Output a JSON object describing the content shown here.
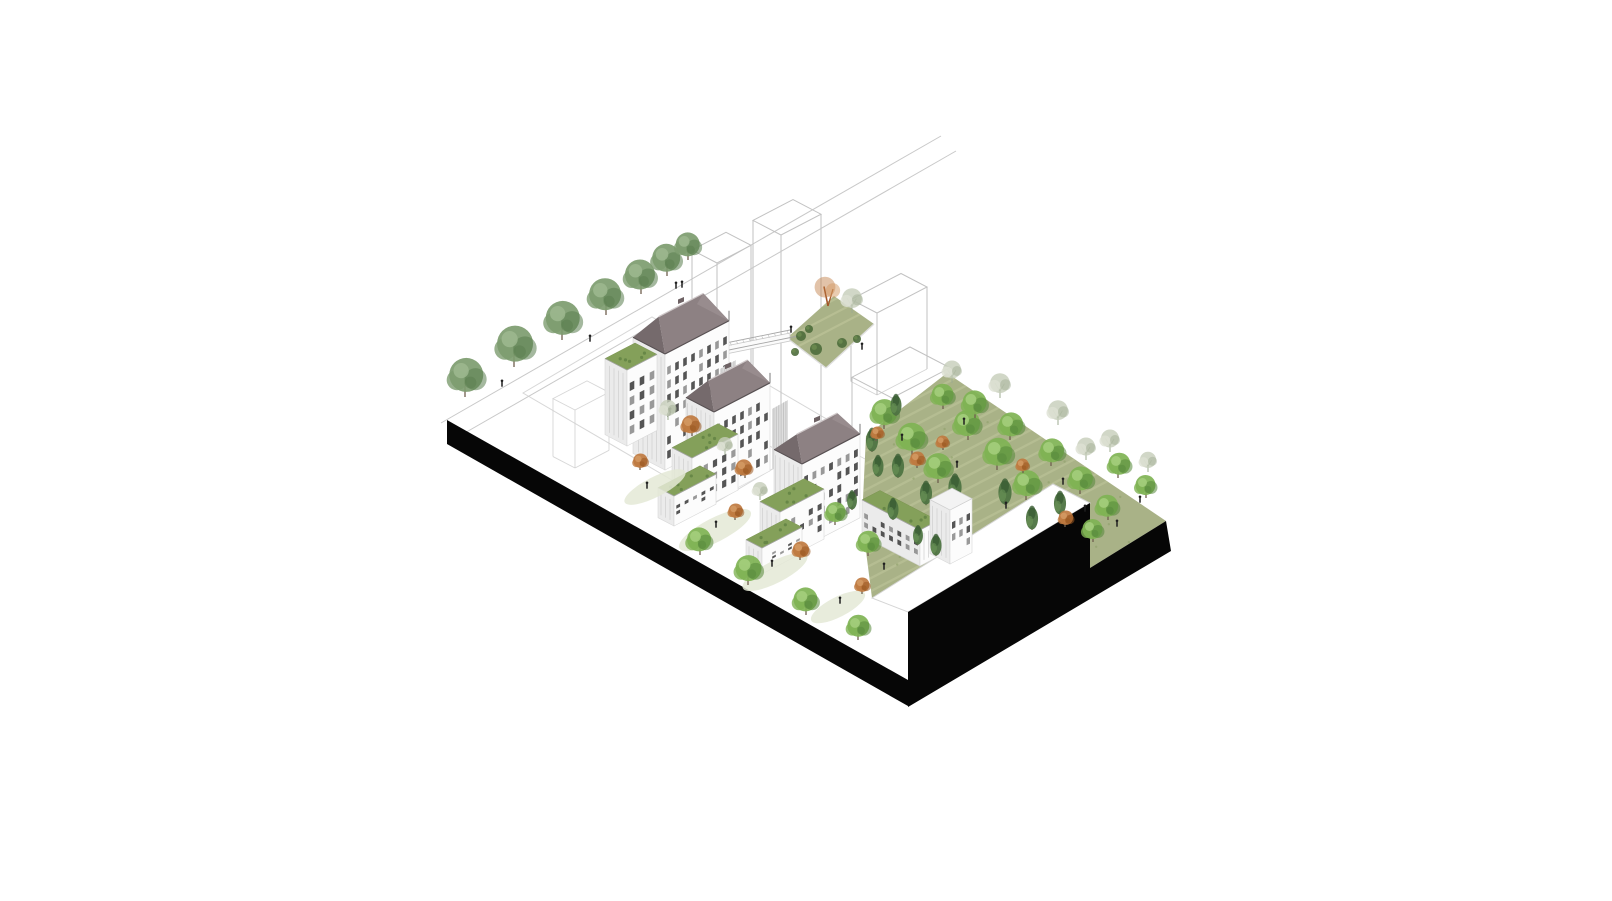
{
  "canvas": {
    "width": 1612,
    "height": 901
  },
  "colors": {
    "background": "#ffffff",
    "black": "#060606",
    "wireframe": "#c2c2c2",
    "groundLine": "#cdcdcd",
    "streetLine": "#b6b6b6",
    "lawn": "#a9b287",
    "lawnStreak": "#c2c89d",
    "lawnEdge": "#dfdfdf",
    "terraceWhite": "#ffffff",
    "terraceEdge": "#d5d5d5",
    "roofFront": "#8d8183",
    "roofHip": "#756a6c",
    "roofBack": "#988c8e",
    "roofRidge": "#cfc8c9",
    "roofEave": "#575052",
    "faceLight": "#fcfcfc",
    "faceShade": "#ebebeb",
    "faceStripe": "#d2d2d2",
    "faceEdge": "#d8d8d8",
    "window": "#3e3e3e",
    "windowLight": "#8b8b8b",
    "greenRoof": "#84a05a",
    "greenRoofDot": "#678747",
    "walkDeck": "#fbfbfb",
    "rail": "#a6a6a6",
    "connector": "#dedede",
    "connectorStripe": "#c2c2c2",
    "figure": "#1f1f1f",
    "trunk": "#6f5f4e",
    "patch": "#e4e9d6",
    "shrub": "#4c6c3b",
    "treeBright": {
      "base": "#7fb354",
      "light": "#a6cf7e",
      "dark": "#55883b"
    },
    "treeMuted": {
      "base": "#7d9c6f",
      "light": "#9db88f",
      "dark": "#5a7d4e"
    },
    "treeConifer": {
      "base": "#4e7442",
      "light": "#6b9457",
      "dark": "#3a5c33"
    },
    "treePale": {
      "base": "#c6cdb9",
      "light": "#dde1d3",
      "dark": "#9dab90"
    },
    "treeOrange": {
      "base": "#bf7a40",
      "light": "#d49a63",
      "dark": "#9a5820"
    }
  },
  "base": {
    "band": [
      [
        447,
        420
      ],
      [
        908,
        680
      ],
      [
        908,
        706
      ],
      [
        447,
        444
      ]
    ],
    "rightMass": [
      [
        908,
        612
      ],
      [
        1090,
        503
      ],
      [
        1090,
        568
      ],
      [
        1166,
        521
      ],
      [
        1171,
        551
      ],
      [
        908,
        707
      ]
    ],
    "terrace": [
      [
        872,
        598
      ],
      [
        1053,
        484
      ],
      [
        1090,
        503
      ],
      [
        908,
        612
      ]
    ],
    "garden": [
      [
        866,
        436
      ],
      [
        947,
        373
      ],
      [
        1166,
        521
      ],
      [
        1090,
        568
      ],
      [
        1090,
        503
      ],
      [
        1053,
        484
      ],
      [
        872,
        598
      ],
      [
        862,
        520
      ]
    ],
    "lawn": [
      [
        787,
        338
      ],
      [
        834,
        296
      ],
      [
        874,
        324
      ],
      [
        826,
        368
      ]
    ]
  },
  "street": {
    "lines": [
      [
        [
          441,
          423
        ],
        [
          941,
          136
        ]
      ],
      [
        [
          456,
          438
        ],
        [
          956,
          151
        ]
      ]
    ],
    "trees": [
      [
        465,
        397,
        17
      ],
      [
        514,
        367,
        18
      ],
      [
        562,
        340,
        17
      ],
      [
        606,
        315,
        16
      ],
      [
        641,
        294,
        15
      ],
      [
        667,
        276,
        14
      ],
      [
        688,
        260,
        12
      ]
    ],
    "figures": [
      [
        502,
        387
      ],
      [
        590,
        342
      ],
      [
        676,
        289
      ],
      [
        682,
        288
      ]
    ]
  },
  "groundOutline": {
    "quad": [
      [
        523,
        393
      ],
      [
        652,
        317
      ],
      [
        842,
        428
      ],
      [
        713,
        504
      ]
    ],
    "box": {
      "o": [
        575,
        468
      ],
      "du": 22,
      "dv": 34,
      "h": 58
    }
  },
  "wireframes": [
    {
      "o": [
        717,
        446
      ],
      "du": 25,
      "dv": 34,
      "h": 183
    },
    {
      "o": [
        781,
        452
      ],
      "du": 28,
      "dv": 40,
      "h": 217
    },
    {
      "o": [
        877,
        395
      ],
      "du": 26,
      "dv": 50,
      "h": 82
    },
    {
      "o": [
        892,
        473
      ],
      "du": 40,
      "dv": 58,
      "h": 75
    }
  ],
  "walkway": {
    "deck": [
      [
        711,
        349
      ],
      [
        790,
        333
      ],
      [
        790,
        341
      ],
      [
        711,
        357
      ]
    ],
    "rails": [
      [
        [
          711,
          346
        ],
        [
          790,
          330
        ]
      ],
      [
        [
          719,
          352
        ],
        [
          798,
          336
        ]
      ]
    ]
  },
  "lawnPlanting": {
    "orangeTree": [
      828,
      306,
      13
    ],
    "paleTree": [
      852,
      313,
      11
    ],
    "shrubs": [
      [
        801,
        336,
        5
      ],
      [
        816,
        349,
        6
      ],
      [
        842,
        343,
        5
      ],
      [
        795,
        352,
        4
      ],
      [
        857,
        339,
        4
      ],
      [
        809,
        329,
        4
      ]
    ],
    "figures": [
      [
        791,
        333
      ],
      [
        862,
        350
      ]
    ]
  },
  "buildings": [
    {
      "id": "b1",
      "o": [
        665,
        470
      ],
      "du": 32,
      "dv": 64,
      "h": 116,
      "roof": "hip",
      "rise": 24,
      "floors": 7,
      "cols": 8
    },
    {
      "id": "b1-wing",
      "o": [
        627,
        446
      ],
      "du": 22,
      "dv": 30,
      "h": 76,
      "roof": "green",
      "floors": 4,
      "cols": 3
    },
    {
      "id": "conn1",
      "type": "connector",
      "quad": [
        [
          720,
          430
        ],
        [
          736,
          421
        ],
        [
          736,
          360
        ],
        [
          720,
          369
        ]
      ]
    },
    {
      "id": "b2",
      "o": [
        714,
        500
      ],
      "du": 28,
      "dv": 56,
      "h": 88,
      "roof": "hip",
      "rise": 20,
      "floors": 5,
      "cols": 7
    },
    {
      "id": "b2-step1",
      "o": [
        692,
        514
      ],
      "du": 20,
      "dv": 46,
      "h": 56,
      "roof": "green",
      "floors": 3,
      "cols": 5
    },
    {
      "id": "b2-step2",
      "o": [
        674,
        526
      ],
      "du": 16,
      "dv": 42,
      "h": 30,
      "roof": "green",
      "floors": 2,
      "cols": 5
    },
    {
      "id": "conn2",
      "type": "connector",
      "quad": [
        [
          772,
          470
        ],
        [
          788,
          461
        ],
        [
          788,
          400
        ],
        [
          772,
          409
        ]
      ]
    },
    {
      "id": "b3",
      "o": [
        802,
        548
      ],
      "du": 28,
      "dv": 58,
      "h": 84,
      "roof": "hip",
      "rise": 18,
      "floors": 5,
      "cols": 7
    },
    {
      "id": "b3-step1",
      "o": [
        780,
        562
      ],
      "du": 20,
      "dv": 44,
      "h": 50,
      "roof": "green",
      "floors": 3,
      "cols": 5
    },
    {
      "id": "b3-step2",
      "o": [
        762,
        574
      ],
      "du": 16,
      "dv": 40,
      "h": 26,
      "roof": "green",
      "floors": 2,
      "cols": 5
    },
    {
      "id": "low-wing",
      "o": [
        920,
        566
      ],
      "du": 58,
      "dv": 18,
      "h": 36,
      "roof": "green",
      "floors": 2,
      "cols": 7
    },
    {
      "id": "end-block",
      "o": [
        950,
        564
      ],
      "du": 20,
      "dv": 22,
      "h": 54,
      "roof": "flat",
      "floors": 3,
      "cols": 3
    }
  ],
  "gardenTrees": [
    [
      884,
      429,
      13,
      "b"
    ],
    [
      912,
      455,
      14,
      "b"
    ],
    [
      938,
      483,
      13,
      "b"
    ],
    [
      968,
      440,
      13,
      "b"
    ],
    [
      997,
      470,
      14,
      "b"
    ],
    [
      1026,
      500,
      13,
      "b"
    ],
    [
      1051,
      466,
      12,
      "b"
    ],
    [
      1080,
      494,
      12,
      "b"
    ],
    [
      1108,
      520,
      11,
      "b"
    ],
    [
      943,
      409,
      11,
      "b"
    ],
    [
      975,
      418,
      12,
      "b"
    ],
    [
      1010,
      440,
      12,
      "b"
    ],
    [
      1118,
      478,
      11,
      "b"
    ],
    [
      1146,
      498,
      10,
      "b"
    ],
    [
      1093,
      542,
      10,
      "b"
    ],
    [
      872,
      452,
      11,
      "c"
    ],
    [
      898,
      478,
      11,
      "c"
    ],
    [
      926,
      505,
      11,
      "c"
    ],
    [
      955,
      500,
      12,
      "c"
    ],
    [
      1005,
      505,
      12,
      "c"
    ],
    [
      1032,
      530,
      11,
      "c"
    ],
    [
      896,
      416,
      10,
      "c"
    ],
    [
      1060,
      515,
      11,
      "c"
    ],
    [
      952,
      383,
      10,
      "p"
    ],
    [
      1000,
      398,
      11,
      "p"
    ],
    [
      1058,
      425,
      11,
      "p"
    ],
    [
      1110,
      452,
      10,
      "p"
    ],
    [
      1148,
      472,
      9,
      "p"
    ],
    [
      1086,
      460,
      10,
      "p"
    ],
    [
      917,
      468,
      8,
      "o"
    ],
    [
      943,
      450,
      7,
      "o"
    ],
    [
      1065,
      527,
      8,
      "o"
    ],
    [
      876,
      441,
      7,
      "o"
    ],
    [
      1023,
      473,
      7,
      "o"
    ]
  ],
  "gardenFigures": [
    [
      902,
      441
    ],
    [
      957,
      468
    ],
    [
      1006,
      509
    ],
    [
      1063,
      485
    ],
    [
      1117,
      527
    ],
    [
      1140,
      503
    ],
    [
      964,
      425
    ],
    [
      1085,
      512
    ]
  ],
  "courtyard": {
    "patches": [
      [
        655,
        487,
        34,
        10
      ],
      [
        715,
        530,
        40,
        12
      ],
      [
        775,
        572,
        36,
        11
      ],
      [
        838,
        607,
        30,
        10
      ]
    ],
    "trees": [
      [
        692,
        436,
        10,
        "o"
      ],
      [
        745,
        478,
        9,
        "o"
      ],
      [
        735,
        520,
        8,
        "o"
      ],
      [
        800,
        560,
        9,
        "o"
      ],
      [
        862,
        594,
        8,
        "o"
      ],
      [
        640,
        470,
        8,
        "o"
      ],
      [
        700,
        555,
        12,
        "b"
      ],
      [
        748,
        585,
        13,
        "b"
      ],
      [
        806,
        615,
        12,
        "b"
      ],
      [
        858,
        640,
        11,
        "b"
      ],
      [
        835,
        525,
        10,
        "b"
      ],
      [
        868,
        556,
        11,
        "b"
      ],
      [
        878,
        477,
        10,
        "c"
      ],
      [
        852,
        510,
        9,
        "c"
      ],
      [
        893,
        520,
        10,
        "c"
      ],
      [
        918,
        545,
        9,
        "c"
      ],
      [
        936,
        556,
        10,
        "c"
      ],
      [
        668,
        420,
        9,
        "p"
      ],
      [
        725,
        455,
        8,
        "p"
      ],
      [
        760,
        500,
        8,
        "p"
      ]
    ],
    "figures": [
      [
        647,
        489
      ],
      [
        716,
        528
      ],
      [
        772,
        567
      ],
      [
        840,
        604
      ],
      [
        884,
        570
      ]
    ]
  }
}
